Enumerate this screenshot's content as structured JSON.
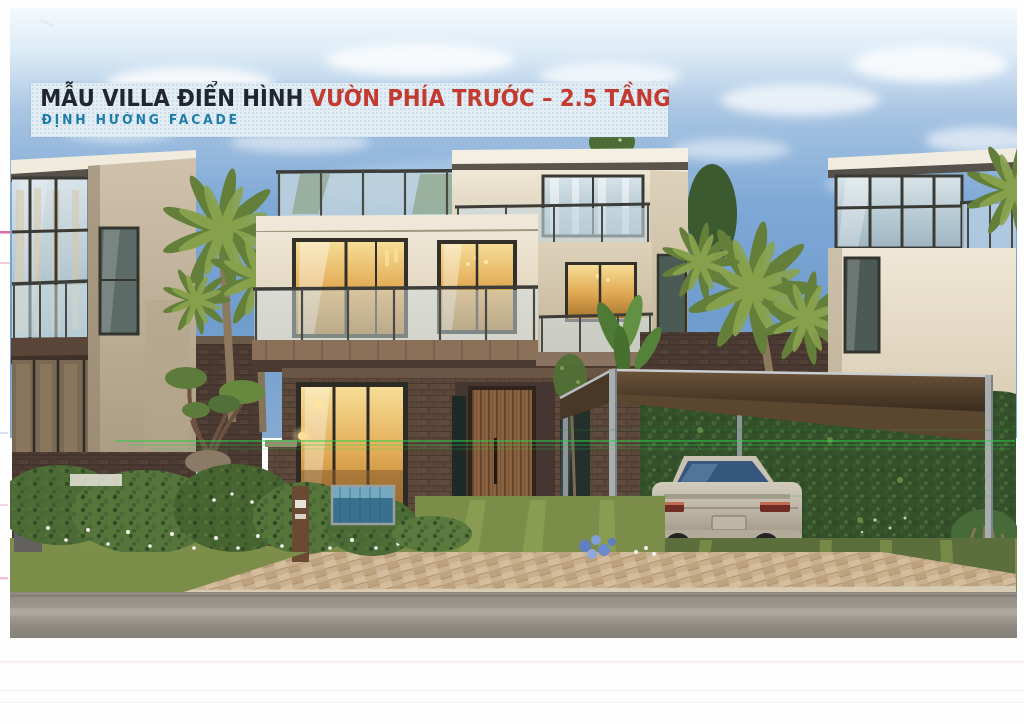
{
  "document": {
    "type": "scanned presentation slide — architectural rendering of a typical villa",
    "page_background": "#fefefe"
  },
  "banner": {
    "title_black": "MẪU VILLA ĐIỂN HÌNH",
    "title_red": "VƯỜN PHÍA TRƯỚC – 2.5 TẦNG",
    "subtitle": "ĐỊNH HƯỚNG FACADE"
  },
  "theme": {
    "title-dark": "#21252c",
    "title-red": "#c33a31",
    "subtitle-teal": "#1d7ca8",
    "banner-bg": "#e3edf4",
    "sky-blue": "#7aa3d0",
    "wall-cream": "#e7decb",
    "wall-taupe": "#c7b9a2",
    "brick-brown": "#5a463a",
    "balcony-glass": "#c5d6de",
    "hedge-green": "#33502a",
    "lawn-olive": "#7d8d4a",
    "paver-tan": "#c6ae8c",
    "road-gray": "#959088",
    "carport-wood": "#5b462f",
    "car-champagne": "#b6ad9d",
    "scan-line-green": "#2ecf4c",
    "scan-mark-pink": "#d9509b"
  }
}
